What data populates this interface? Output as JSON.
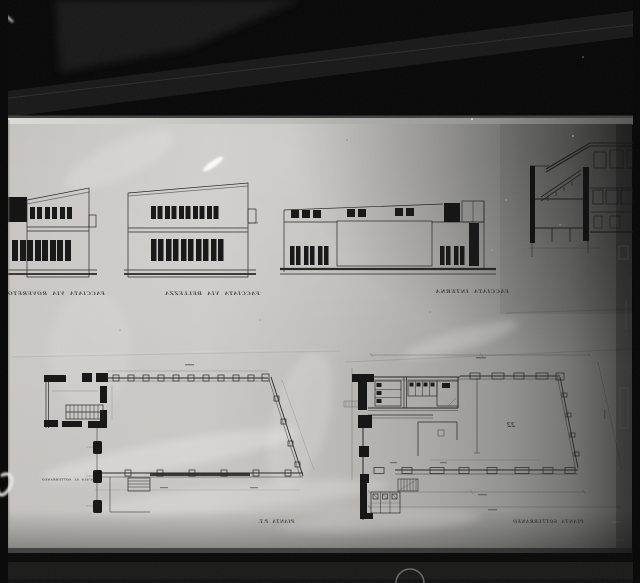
{
  "photo": {
    "description": "Black-and-white photograph of architectural drawings laid on a dark backlit surface: three building elevations and a cross-section in the upper half, two large floor plans in the lower half",
    "tones": {
      "background_black": "#060606",
      "paper_light": "#c6c5c2",
      "paper_shadow_right": "#565656",
      "ink_line": "#232321",
      "highlight_white": "#eceae6"
    }
  },
  "captions": {
    "style_note": "hand-lettered captions appear mirrored and slightly blurred in the photograph",
    "elevation_a": "FACCIATA VIA ROVERETO",
    "elevation_b": "FACCIATA VIA BELLEZZA",
    "elevation_c": "FACCIATA INTERNA",
    "plan_left_side_note": "SCALA AL SOTTERRANEO",
    "plan_left": "PIANTA P.T.",
    "plan_right": "PIANTA SOTTERRANEO",
    "hall_number": "22"
  },
  "drawings": {
    "elevation_a": "two-storey building elevation with ribbon windows",
    "elevation_b": "two-storey building elevation with ribbon windows",
    "elevation_c": "long low building elevation with clerestory windows",
    "section": "building cross-section with staircase",
    "plan_left": "floor plan with stair block, colonnade and slanted wall",
    "plan_right": "floor plan with service rooms and large trapezoidal hall"
  }
}
